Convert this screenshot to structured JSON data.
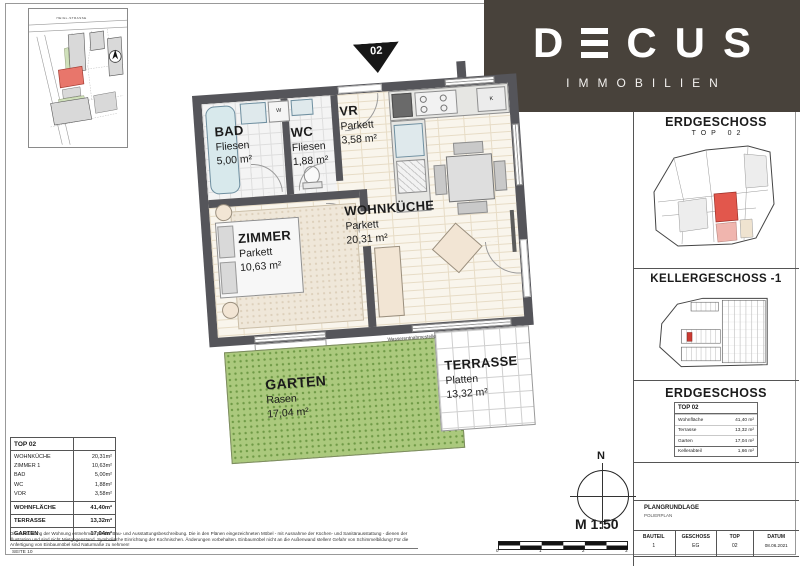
{
  "colors": {
    "banner": "#48423b",
    "wall": "#55555a",
    "garden_green": "#abc97d",
    "unit_highlight_red": "#e2574c"
  },
  "brand": {
    "name": "DECUS",
    "letters": [
      "D",
      "E",
      "C",
      "U",
      "S"
    ],
    "subtitle": "IMMOBILIEN"
  },
  "site_map": {
    "street_label": "HEIGL-STRASSE"
  },
  "floorplan": {
    "unit_marker": "02",
    "rooms": [
      {
        "name": "BAD",
        "floor": "Fliesen",
        "area": "5,00 m²"
      },
      {
        "name": "WC",
        "floor": "Fliesen",
        "area": "1,88 m²"
      },
      {
        "name": "VR",
        "floor": "Parkett",
        "area": "3,58 m²"
      },
      {
        "name": "WOHNKÜCHE",
        "floor": "Parkett",
        "area": "20,31 m²"
      },
      {
        "name": "ZIMMER",
        "floor": "Parkett",
        "area": "10,63 m²"
      },
      {
        "name": "GARTEN",
        "floor": "Rasen",
        "area": "17,04 m²"
      },
      {
        "name": "TERRASSE",
        "floor": "Platten",
        "area": "13,32 m²"
      }
    ],
    "annotations": {
      "washer": "W",
      "fridge": "K",
      "water_tap": "Wasserentnahmestelle"
    }
  },
  "sidebar": {
    "section1": {
      "title": "ERDGESCHOSS",
      "subtitle": "TOP 02"
    },
    "section2": {
      "title": "KELLERGESCHOSS -1"
    },
    "section3": {
      "title": "ERDGESCHOSS"
    },
    "unit_table": {
      "header": "TOP 02",
      "rows": [
        {
          "label": "Wohnfläche",
          "value": "41,40 m²"
        },
        {
          "label": "Terrasse",
          "value": "13,32 m²"
        },
        {
          "label": "Garten",
          "value": "17,04 m²"
        },
        {
          "label": "Kellerabteil",
          "value": "1,66 m²"
        }
      ]
    },
    "title_block": {
      "title": "PLANGRUNDLAGE",
      "subtitle": "POLIERPLAN",
      "fields": [
        {
          "label": "BAUTEIL",
          "value": "1"
        },
        {
          "label": "GESCHOSS",
          "value": "EG"
        },
        {
          "label": "TOP",
          "value": "02"
        },
        {
          "label": "DATUM",
          "value": "08.06.2021"
        }
      ]
    }
  },
  "area_table": {
    "header": "TOP 02",
    "rooms": [
      {
        "label": "WOHNKÜCHE",
        "value": "20,31m²"
      },
      {
        "label": "ZIMMER 1",
        "value": "10,63m²"
      },
      {
        "label": "BAD",
        "value": "5,00m²"
      },
      {
        "label": "WC",
        "value": "1,88m²"
      },
      {
        "label": "VOR",
        "value": "3,58m²"
      }
    ],
    "totals": [
      {
        "label": "WOHNFLÄCHE",
        "value": "41,40m²"
      },
      {
        "label": "TERRASSE",
        "value": "13,32m²"
      },
      {
        "label": "GARTEN",
        "value": "17,04m²"
      }
    ]
  },
  "legend": {
    "north": "N",
    "scale": "M 1:50",
    "ticks": [
      "0",
      "1",
      "2",
      "3"
    ]
  },
  "footer": {
    "disclaimer": "Die Ausstattung der Wohnung entnehmen Sie der Bau- und Ausstattungsbeschreibung. Die in den Plänen eingezeichneten Möbel - mit Ausnahme der Küchen- und Sanitärausstattung - dienen der Illustration und sind nicht Mietgegenstand. Symbolische Einrichtung der Kochnischen. Änderungen vorbehalten. Einbaumöbel nicht an die Außenwand stellen! Gefahr von Schimmelbildung! Für die Anfertigung von Einbaumöbel sind Naturmaße zu nehmen!",
    "page": "SEITE 10"
  }
}
